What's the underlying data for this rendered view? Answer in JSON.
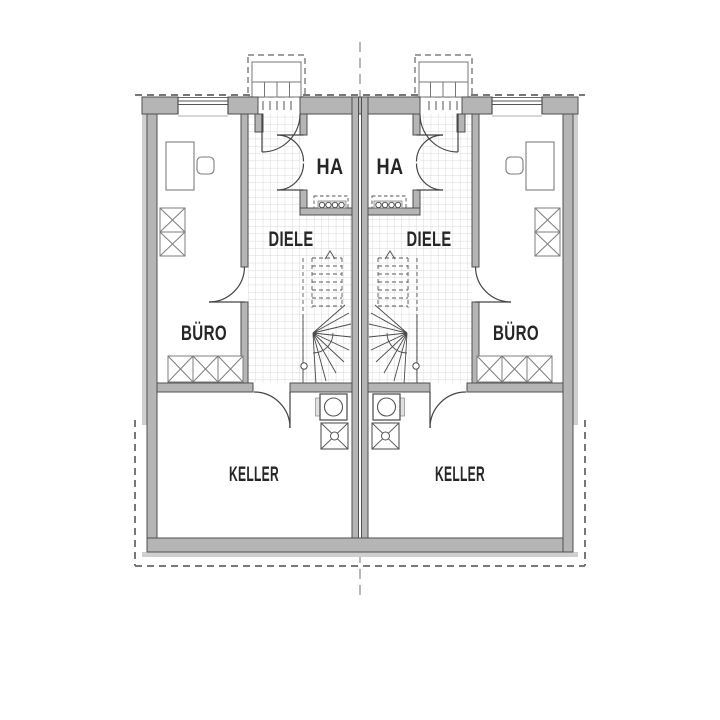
{
  "drawing": {
    "kind": "floor-plan",
    "level": "basement",
    "layout": "two mirrored dwelling units around central party wall"
  },
  "rooms": {
    "left_unit": {
      "office": "BÜRO",
      "hall": "DIELE",
      "service": "HA",
      "cellar": "KELLER"
    },
    "right_unit": {
      "office": "BÜRO",
      "hall": "DIELE",
      "service": "HA",
      "cellar": "KELLER"
    }
  },
  "colors": {
    "background": "#ffffff",
    "wall_fill": "#b5b5b5",
    "wall_edge": "#4f4f4f",
    "insulation_band": "#cfcfcf",
    "tile_grid": "#cccccc",
    "line_work": "#444444",
    "furniture_line": "#7d7d7d",
    "dashed_line": "#787878",
    "label_text": "#262626"
  },
  "symbols": {
    "desk": "desk",
    "chair": "office-chair",
    "wardrobe": "crossed storage unit",
    "shelf_row": "crossed shelf row",
    "washer": "washing machine connection",
    "drain": "floor drain",
    "stairs": "winder stair (up)",
    "meters": "house connection meters",
    "stoop": "entrance steps",
    "canopy": "canopy outline (dashed)",
    "axis": "symmetry axis (dashed)"
  }
}
